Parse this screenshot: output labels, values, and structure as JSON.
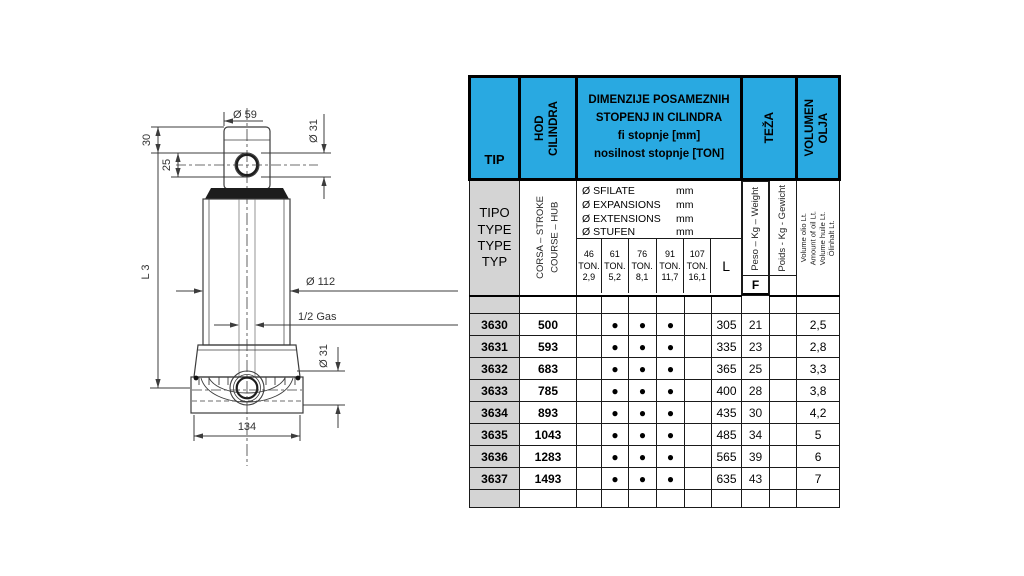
{
  "colors": {
    "header_cyan": "#29A9E1",
    "cell_grey": "#D4D4D4",
    "line": "#3c3c3c"
  },
  "diagram": {
    "dims": {
      "top_width": "Ø 59",
      "top_eye_dia": "Ø 31",
      "cap_height": "30",
      "eye_offset": "25",
      "closed_length": "L 3",
      "body_dia": "Ø 112",
      "port": "1/2 Gas",
      "base_eye_dia": "Ø 31",
      "base_width": "134"
    }
  },
  "table": {
    "header": {
      "tip": "TIP",
      "hod_lines": [
        "HOD",
        "CILINDRA"
      ],
      "dim_lines": [
        "DIMENZIJE POSAMEZNIH",
        "STOPENJ IN CILINDRA",
        "fi stopnje [mm]",
        "nosilnost stopnje [TON]"
      ],
      "teza": "TEŽA",
      "vol_lines": [
        "VOLUMEN",
        "OLJA"
      ]
    },
    "subheader": {
      "tipo_lines": [
        "TIPO",
        "TYPE",
        "TYPE",
        "TYP"
      ],
      "corsa_lines": [
        "CORSA  – STROKE",
        "COURSE – HUB"
      ],
      "fi_lines": [
        {
          "label": "Ø SFILATE",
          "unit": "mm"
        },
        {
          "label": "Ø EXPANSIONS",
          "unit": "mm"
        },
        {
          "label": "Ø EXTENSIONS",
          "unit": "mm"
        },
        {
          "label": "Ø STUFEN",
          "unit": "mm"
        }
      ],
      "ton_cols": [
        [
          "46",
          "TON.",
          "2,9"
        ],
        [
          "61",
          "TON.",
          "5,2"
        ],
        [
          "76",
          "TON.",
          "8,1"
        ],
        [
          "91",
          "TON.",
          "11,7"
        ],
        [
          "107",
          "TON.",
          "16,1"
        ]
      ],
      "l_label": "L",
      "peso": "Peso – Kg – Weight",
      "f_label": "F",
      "poids": "Poids - Kg - Gewicht",
      "volume_lines": [
        "Volume olio Lt.",
        "Amount of oil Lt.",
        "Volume huile Lt.",
        "Ölinhalt Lt."
      ]
    },
    "rows": [
      {
        "tip": "3630",
        "stroke": "500",
        "stages": [
          "",
          "●",
          "●",
          "●",
          ""
        ],
        "l": "305",
        "weight": "21",
        "poids": "",
        "volume": "2,5"
      },
      {
        "tip": "3631",
        "stroke": "593",
        "stages": [
          "",
          "●",
          "●",
          "●",
          ""
        ],
        "l": "335",
        "weight": "23",
        "poids": "",
        "volume": "2,8"
      },
      {
        "tip": "3632",
        "stroke": "683",
        "stages": [
          "",
          "●",
          "●",
          "●",
          ""
        ],
        "l": "365",
        "weight": "25",
        "poids": "",
        "volume": "3,3"
      },
      {
        "tip": "3633",
        "stroke": "785",
        "stages": [
          "",
          "●",
          "●",
          "●",
          ""
        ],
        "l": "400",
        "weight": "28",
        "poids": "",
        "volume": "3,8"
      },
      {
        "tip": "3634",
        "stroke": "893",
        "stages": [
          "",
          "●",
          "●",
          "●",
          ""
        ],
        "l": "435",
        "weight": "30",
        "poids": "",
        "volume": "4,2"
      },
      {
        "tip": "3635",
        "stroke": "1043",
        "stages": [
          "",
          "●",
          "●",
          "●",
          ""
        ],
        "l": "485",
        "weight": "34",
        "poids": "",
        "volume": "5"
      },
      {
        "tip": "3636",
        "stroke": "1283",
        "stages": [
          "",
          "●",
          "●",
          "●",
          ""
        ],
        "l": "565",
        "weight": "39",
        "poids": "",
        "volume": "6"
      },
      {
        "tip": "3637",
        "stroke": "1493",
        "stages": [
          "",
          "●",
          "●",
          "●",
          ""
        ],
        "l": "635",
        "weight": "43",
        "poids": "",
        "volume": "7"
      }
    ]
  }
}
